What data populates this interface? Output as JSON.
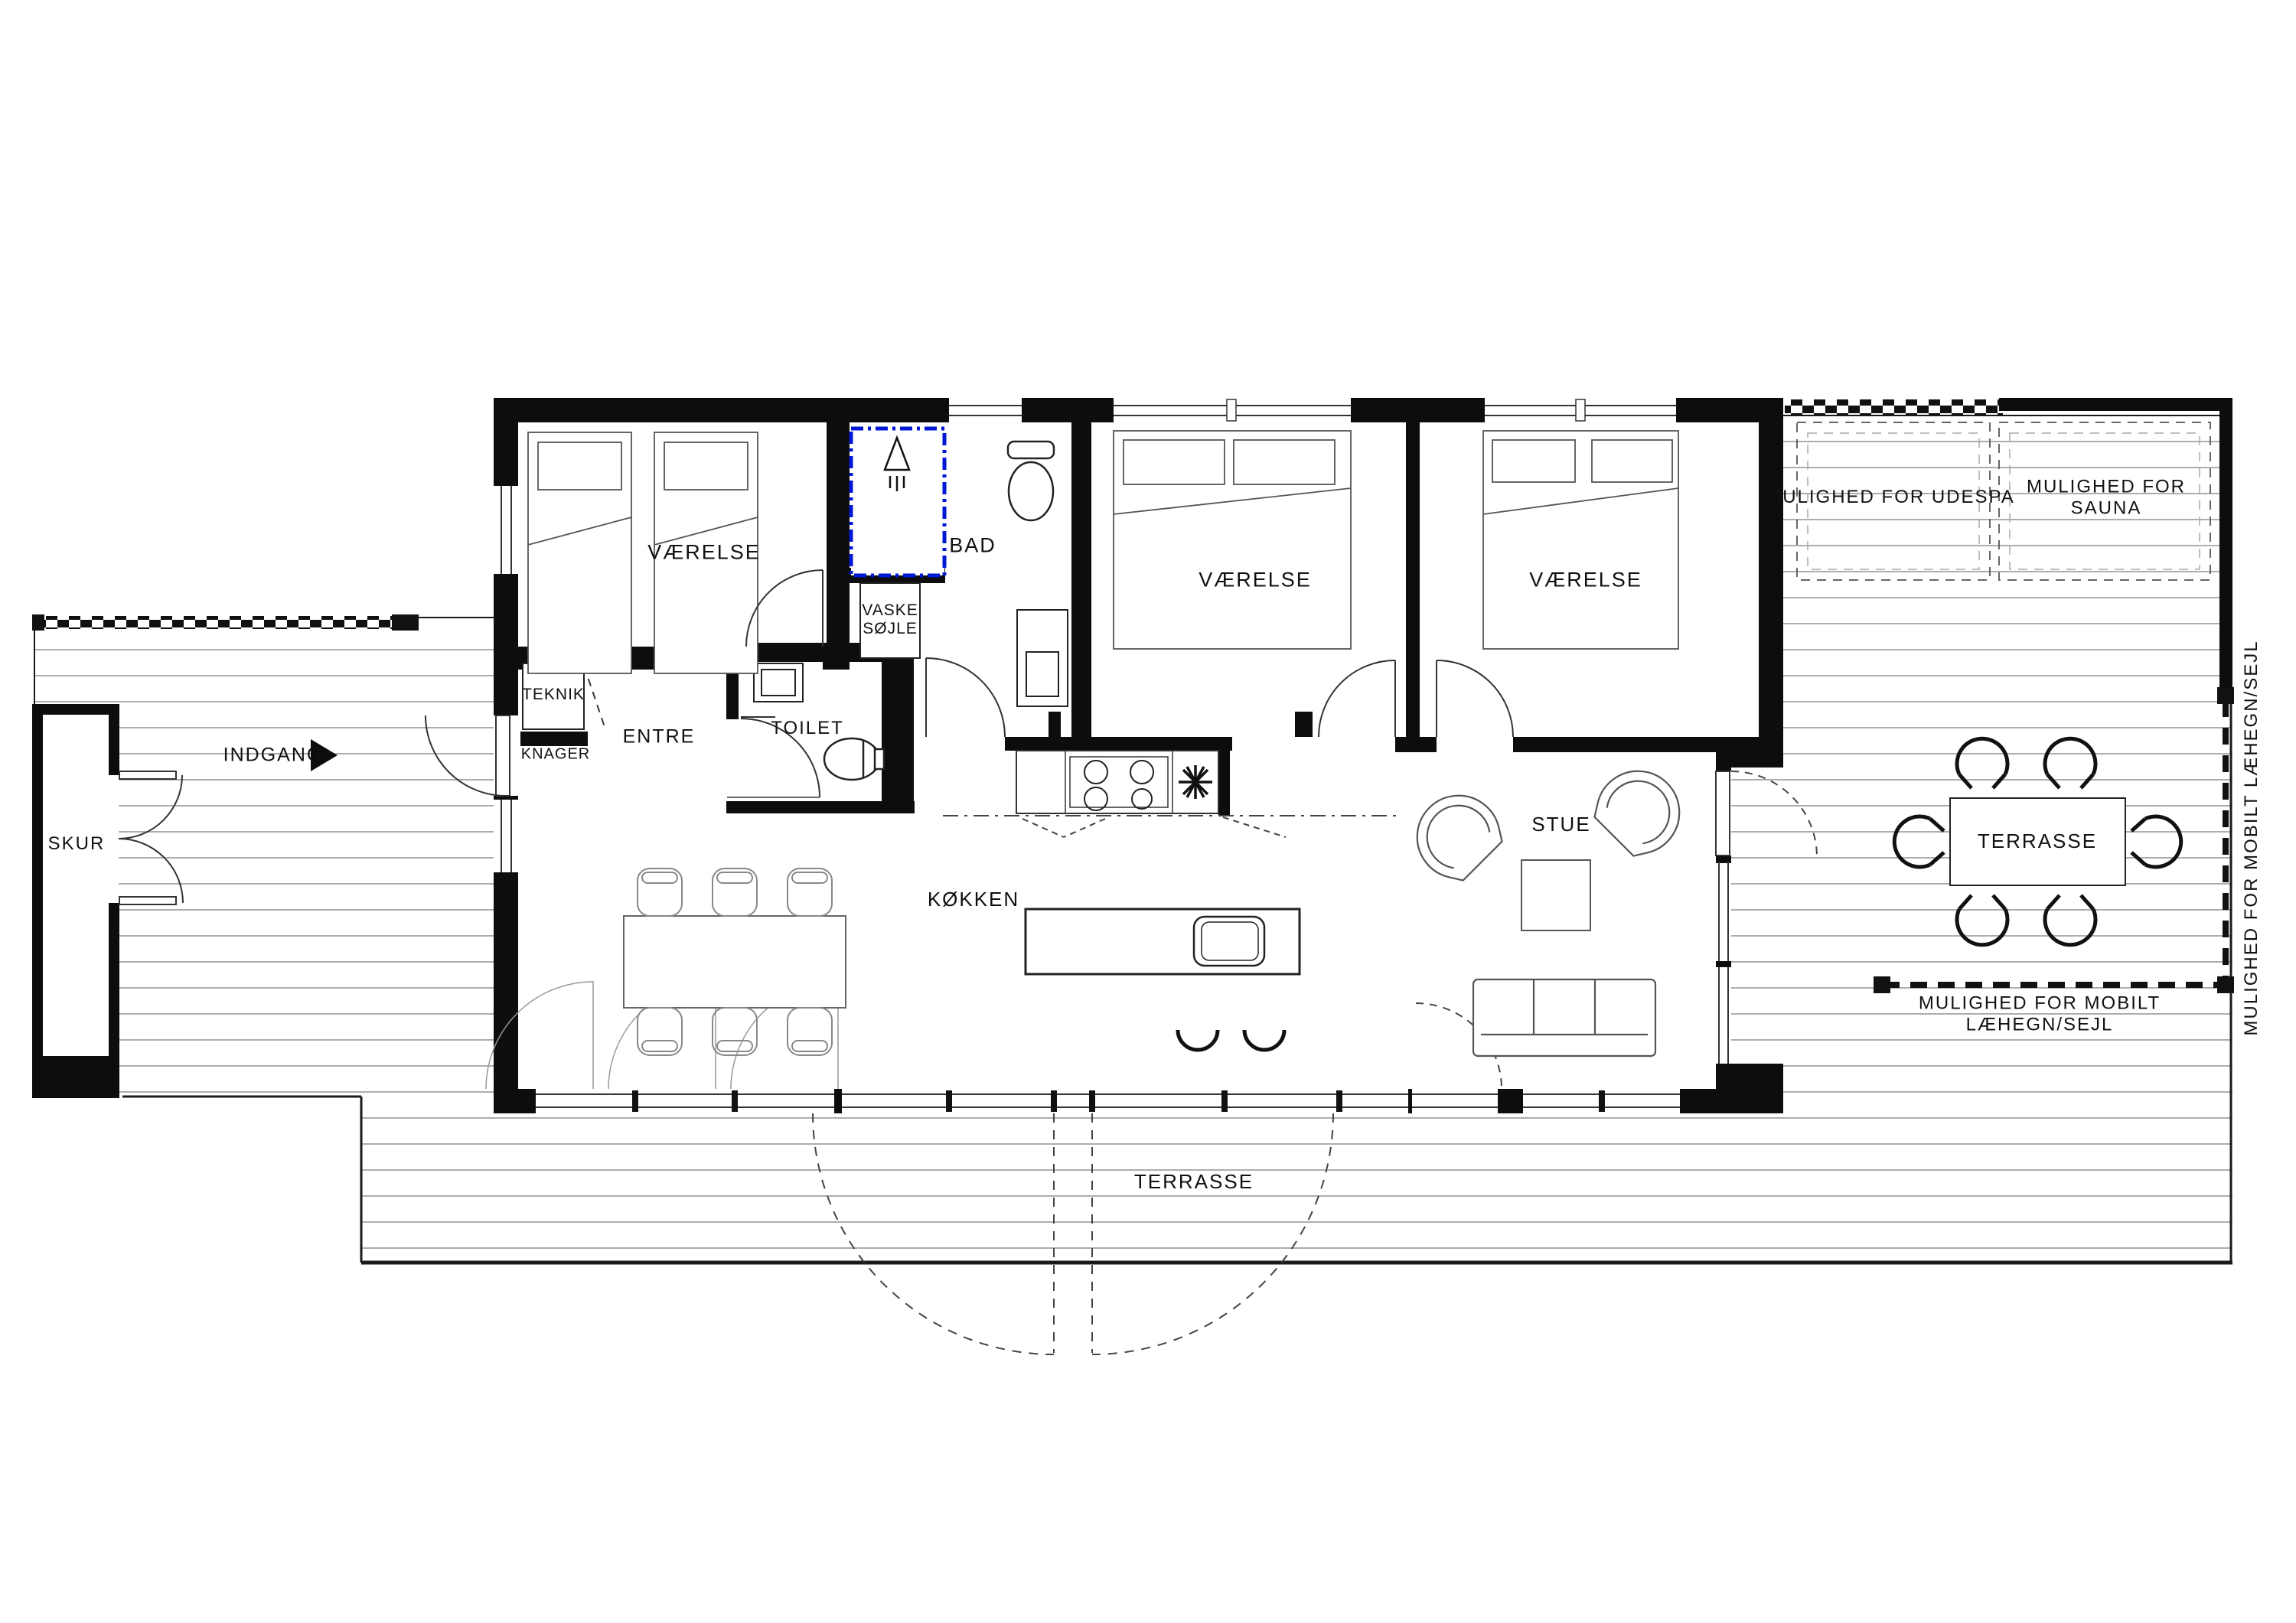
{
  "labels": {
    "vaerelse": "VÆRELSE",
    "bad": "BAD",
    "vaske": "VASKE\nSØJLE",
    "teknik": "TEKNIK",
    "knager": "KNAGER",
    "entre": "ENTRE",
    "toilet": "TOILET",
    "indgang": "INDGANG",
    "skur": "SKUR",
    "kokken": "KØKKEN",
    "stue": "STUE",
    "terrasse": "TERRASSE",
    "udespa": "MULIGHED FOR UDESPA",
    "sauna": "MULIGHED FOR SAUNA",
    "laehegn": "MULIGHED FOR MOBILT LÆHEGN/SEJL"
  },
  "colors": {
    "wall": "#0d0d0d",
    "shower_blue": "#0018d4",
    "deck_line": "#adadad",
    "fixture": "#333333"
  }
}
